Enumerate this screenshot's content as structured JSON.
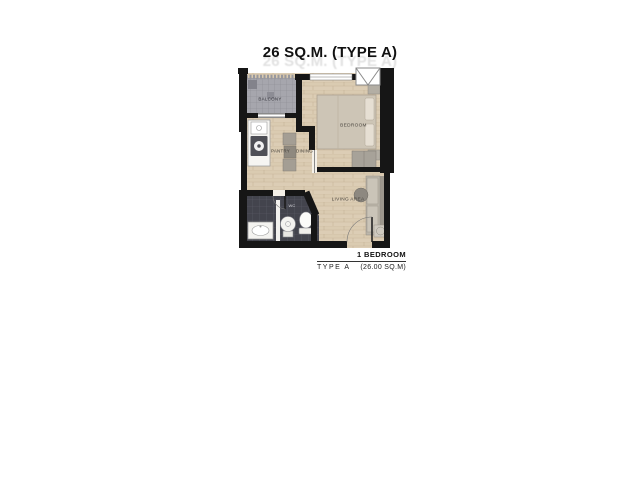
{
  "title": {
    "text": "26 SQ.M. (TYPE A)"
  },
  "plan": {
    "rooms": {
      "balcony": "BALCONY",
      "pantry": "PANTRY",
      "dining": "DINING",
      "bedroom": "BEDROOM",
      "living_area": "LIVING AREA",
      "wc": "WC"
    }
  },
  "legend": {
    "unit": "1 BEDROOM",
    "type": "TYPE A",
    "area": "(26.00 SQ.M)"
  },
  "colors": {
    "wall": "#161616",
    "wood_floor": "#dccdb5",
    "balcony_tile": "#a6a6ad",
    "bath_tile": "#43444d",
    "page_bg": "#ffffff"
  }
}
